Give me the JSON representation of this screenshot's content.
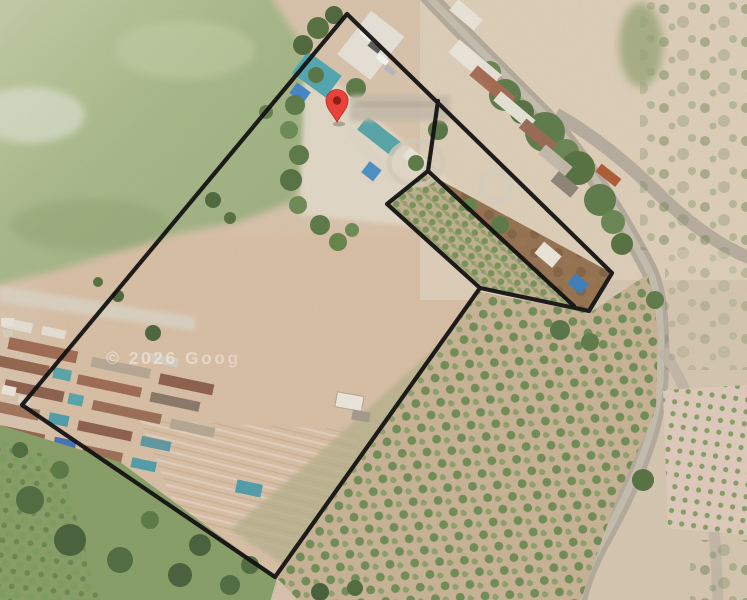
{
  "map": {
    "type": "satellite-imagery-view",
    "watermark": {
      "text": "© 2026 Goog"
    },
    "marker": {
      "name": "red-location-pin",
      "tip_x": 337,
      "tip_y": 122,
      "fill": "#E8423A",
      "inner_dot": "#8E1F12"
    },
    "boundary": {
      "color": "#101010",
      "stroke_width": 4.2,
      "main_polygon": [
        [
          347,
          14
        ],
        [
          612,
          273
        ],
        [
          589,
          311
        ],
        [
          480,
          288
        ],
        [
          275,
          577
        ],
        [
          22,
          405
        ]
      ],
      "slit_polyline": [
        [
          438,
          101
        ],
        [
          428,
          171
        ],
        [
          387,
          204
        ],
        [
          480,
          288
        ]
      ],
      "divider_line": [
        [
          428,
          171
        ],
        [
          574,
          306
        ]
      ]
    },
    "palette": {
      "field_green": "#a9bc8b",
      "dirt_tan": "#dcc7b0",
      "road_gray": "#b6ad9f",
      "orchard_green": "#6a8c52",
      "teal_roof": "#4fa9b4",
      "brown_yard": "#926e4d"
    }
  }
}
